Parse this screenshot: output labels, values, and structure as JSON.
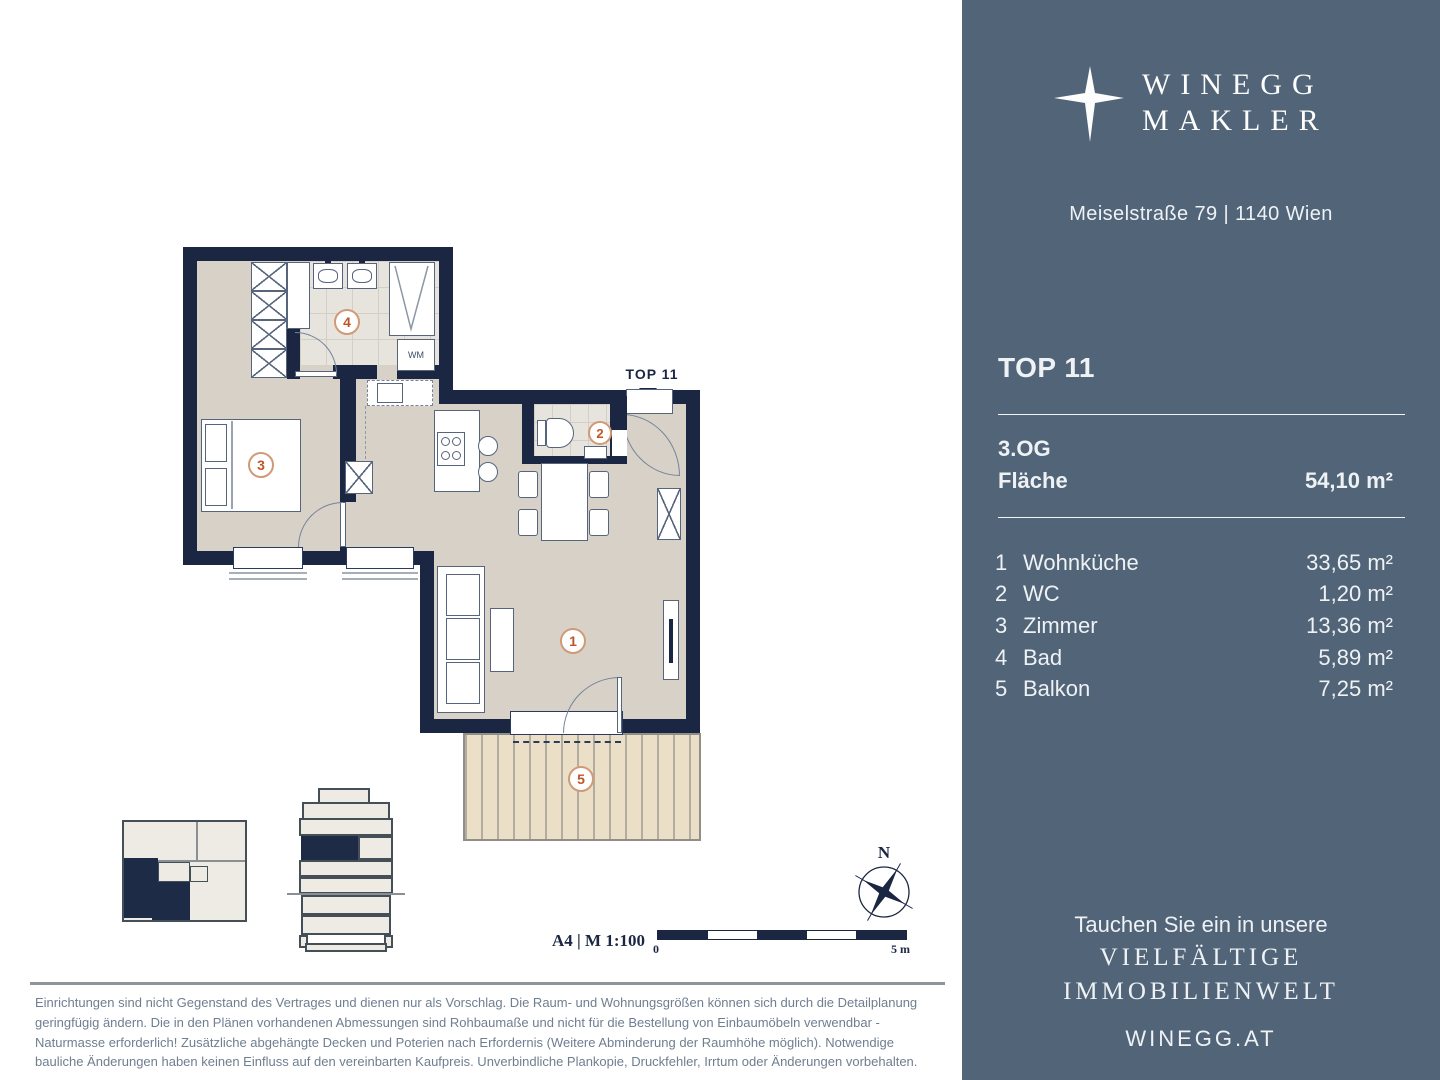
{
  "colors": {
    "sidebar_bg": "#526478",
    "wall_navy": "#1b2742",
    "floor_greige": "#d8d1c7",
    "marker_orange": "#bf5426",
    "disclaimer_text": "#6f7e90"
  },
  "sidebar": {
    "logo": {
      "line1": "WINEGG",
      "line2": "MAKLER",
      "icon": "four-point-star"
    },
    "address": "Meiselstraße 79 | 1140 Wien",
    "unit_title": "TOP 11",
    "floor_label": "3.OG",
    "area_label": "Fläche",
    "area_value": "54,10 m²",
    "rooms": [
      {
        "num": "1",
        "name": "Wohnküche",
        "area": "33,65 m²"
      },
      {
        "num": "2",
        "name": "WC",
        "area": "1,20 m²"
      },
      {
        "num": "3",
        "name": "Zimmer",
        "area": "13,36 m²"
      },
      {
        "num": "4",
        "name": "Bad",
        "area": "5,89 m²"
      },
      {
        "num": "5",
        "name": "Balkon",
        "area": "7,25 m²"
      }
    ],
    "tagline_line1": "Tauchen Sie ein in unsere",
    "tagline_line2": "VIELFÄLTIGE",
    "tagline_line3": "IMMOBILIENWELT",
    "website": "WINEGG.AT"
  },
  "plan": {
    "entrance_label": "TOP 11",
    "washing_machine": "WM",
    "north": "N",
    "scale_caption": "A4 | M 1:100",
    "scale_zero": "0",
    "scale_end": "5 m",
    "markers": [
      "1",
      "2",
      "3",
      "4",
      "5"
    ]
  },
  "disclaimer": "Einrichtungen sind nicht Gegenstand des Vertrages und dienen nur als Vorschlag. Die Raum- und Wohnungsgrößen können sich durch die Detailplanung geringfügig ändern. Die in den Plänen vorhandenen Abmessungen sind Rohbaumaße und nicht für die Bestellung von Einbaumöbeln verwendbar - Naturmasse erforderlich! Zusätzliche abgehängte Decken und Poterien nach Erfordernis (Weitere Abminderung der Raumhöhe möglich). Notwendige bauliche Änderungen haben keinen Einfluss auf den vereinbarten Kaufpreis. Unverbindliche Plankopie, Druckfehler, Irrtum oder Änderungen vorbehalten."
}
